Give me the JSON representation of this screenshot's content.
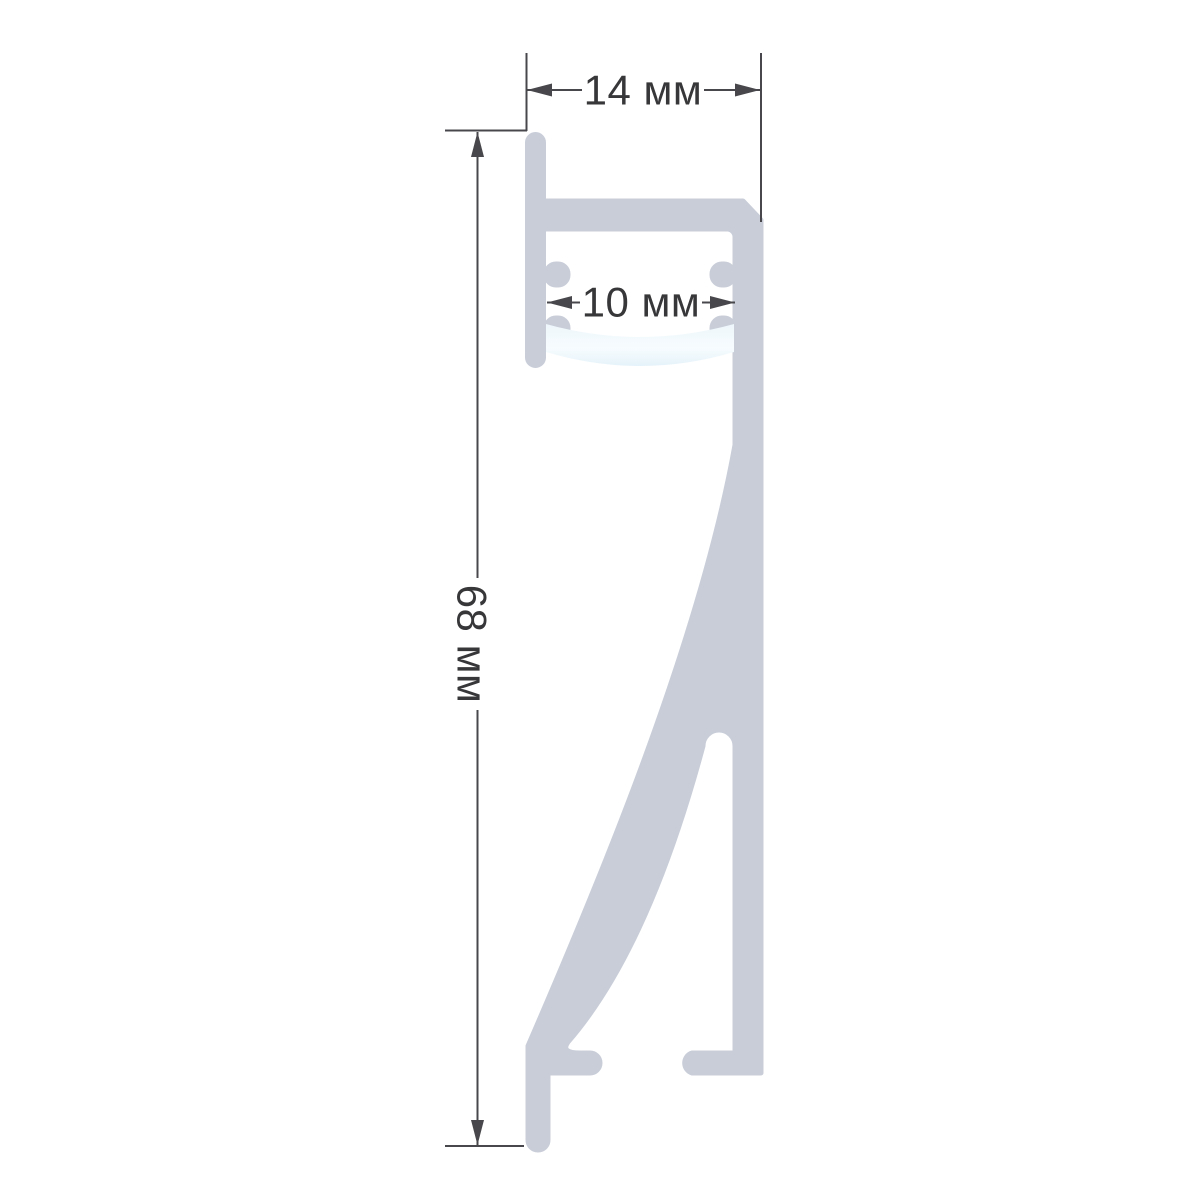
{
  "drawing": {
    "dimensions": {
      "width_label": "14 мм",
      "slot_label": "10 мм",
      "height_label": "68 мм"
    },
    "colors": {
      "background": "#ffffff",
      "profile": "#c8cdd8",
      "diffuser_top": "#edf6fb",
      "diffuser_mid": "#f7fcfe",
      "diffuser_bottom": "#d7ebf6",
      "dimension_lines": "#48484c",
      "text": "#37373a"
    }
  }
}
